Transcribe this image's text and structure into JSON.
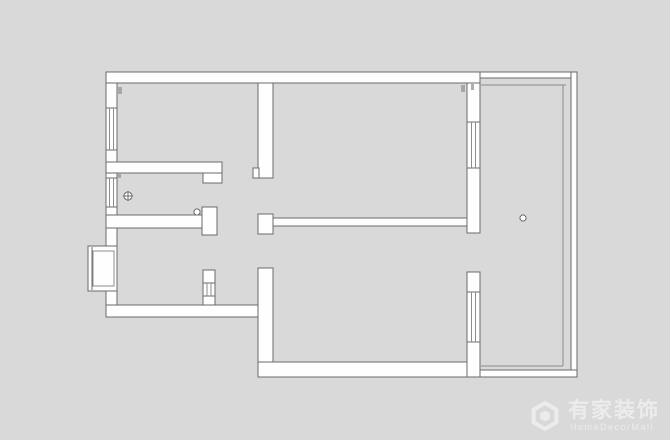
{
  "watermark": {
    "brand": "有家装饰",
    "subtitle": "HomeDecorMall"
  },
  "colors": {
    "background": "#d9d9d9",
    "wall_fill": "#fefefe",
    "wall_stroke": "#6a6a6a",
    "window_stroke": "#8c8c8c",
    "tick": "#9a9a9a",
    "watermark": "#ffffff"
  },
  "floorplan": {
    "canvas": {
      "width": 670,
      "height": 440
    },
    "walls": [
      [
        106,
        72,
        374,
        11
      ],
      [
        106,
        83,
        11,
        25
      ],
      [
        106,
        150,
        11,
        28
      ],
      [
        106,
        207,
        11,
        39
      ],
      [
        106,
        291,
        11,
        26
      ],
      [
        106,
        305,
        162,
        12
      ],
      [
        203,
        270,
        12,
        35
      ],
      [
        258,
        83,
        15,
        95
      ],
      [
        253,
        168,
        6,
        10
      ],
      [
        258,
        214,
        15,
        20
      ],
      [
        258,
        268,
        15,
        109
      ],
      [
        258,
        362,
        222,
        15
      ],
      [
        467,
        83,
        13,
        39
      ],
      [
        467,
        168,
        13,
        65
      ],
      [
        467,
        272,
        13,
        20
      ],
      [
        467,
        342,
        13,
        35
      ],
      [
        106,
        162,
        116,
        11
      ],
      [
        203,
        173,
        19,
        10
      ],
      [
        106,
        215,
        97,
        13
      ],
      [
        202,
        207,
        15,
        28
      ],
      [
        273,
        218,
        194,
        8
      ],
      [
        480,
        72,
        97,
        6
      ],
      [
        571,
        72,
        6,
        305
      ],
      [
        480,
        370,
        97,
        7
      ]
    ],
    "windows": [
      [
        106,
        108,
        11,
        42
      ],
      [
        106,
        178,
        11,
        29
      ],
      [
        467,
        122,
        13,
        46
      ],
      [
        467,
        292,
        13,
        50
      ],
      [
        203,
        283,
        12,
        13
      ]
    ],
    "glass_lines": [
      [
        481,
        85,
        566,
        85
      ],
      [
        563,
        85,
        563,
        366
      ],
      [
        481,
        366,
        563,
        366
      ]
    ],
    "entry_bay": {
      "outer": [
        88,
        246,
        29,
        45
      ],
      "leaf_line": [
        92,
        247,
        92,
        290
      ],
      "inner": [
        93,
        251,
        21,
        35
      ]
    },
    "symbols": [
      {
        "cx": 128,
        "cy": 196,
        "r": 4,
        "cross": true
      },
      {
        "cx": 197,
        "cy": 212,
        "r": 3,
        "cross": false
      },
      {
        "cx": 523,
        "cy": 218,
        "r": 3,
        "cross": false
      }
    ],
    "ticks": [
      [
        118,
        87,
        4,
        7
      ],
      [
        461,
        85,
        4,
        7
      ],
      [
        471,
        84,
        3,
        6
      ],
      [
        117,
        174,
        4,
        4
      ]
    ]
  }
}
